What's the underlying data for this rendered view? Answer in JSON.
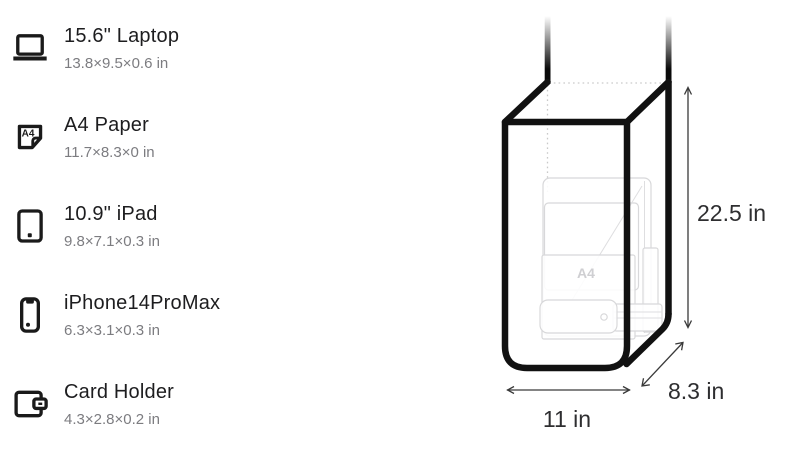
{
  "page": {
    "background": "#ffffff",
    "description_labels": {
      "height": "22.5 in",
      "width": "11 in",
      "depth": "8.3 in"
    }
  },
  "list": {
    "items": [
      {
        "icon": "laptop-icon",
        "title": "15.6\" Laptop",
        "dimensions": "13.8×9.5×0.6 in"
      },
      {
        "icon": "a4-paper-icon",
        "title": "A4 Paper",
        "dimensions": "11.7×8.3×0 in",
        "icon_label": "A4"
      },
      {
        "icon": "ipad-icon",
        "title": "10.9\" iPad",
        "dimensions": "9.8×7.1×0.3 in"
      },
      {
        "icon": "iphone-icon",
        "title": "iPhone14ProMax",
        "dimensions": "6.3×3.1×0.3 in"
      },
      {
        "icon": "card-holder-icon",
        "title": "Card Holder",
        "dimensions": "4.3×2.8×0.2 in"
      }
    ]
  },
  "diagram": {
    "type": "tote-bag-dimension-illustration",
    "height_label": "22.5 in",
    "width_label": "11 in",
    "depth_label": "8.3 in",
    "watermark": "A4",
    "colors": {
      "outline": "#111111",
      "ghost_items": "#d8d8da",
      "hidden_edges": "#c9c9c9",
      "dimension_text": "#2e2e30"
    }
  }
}
